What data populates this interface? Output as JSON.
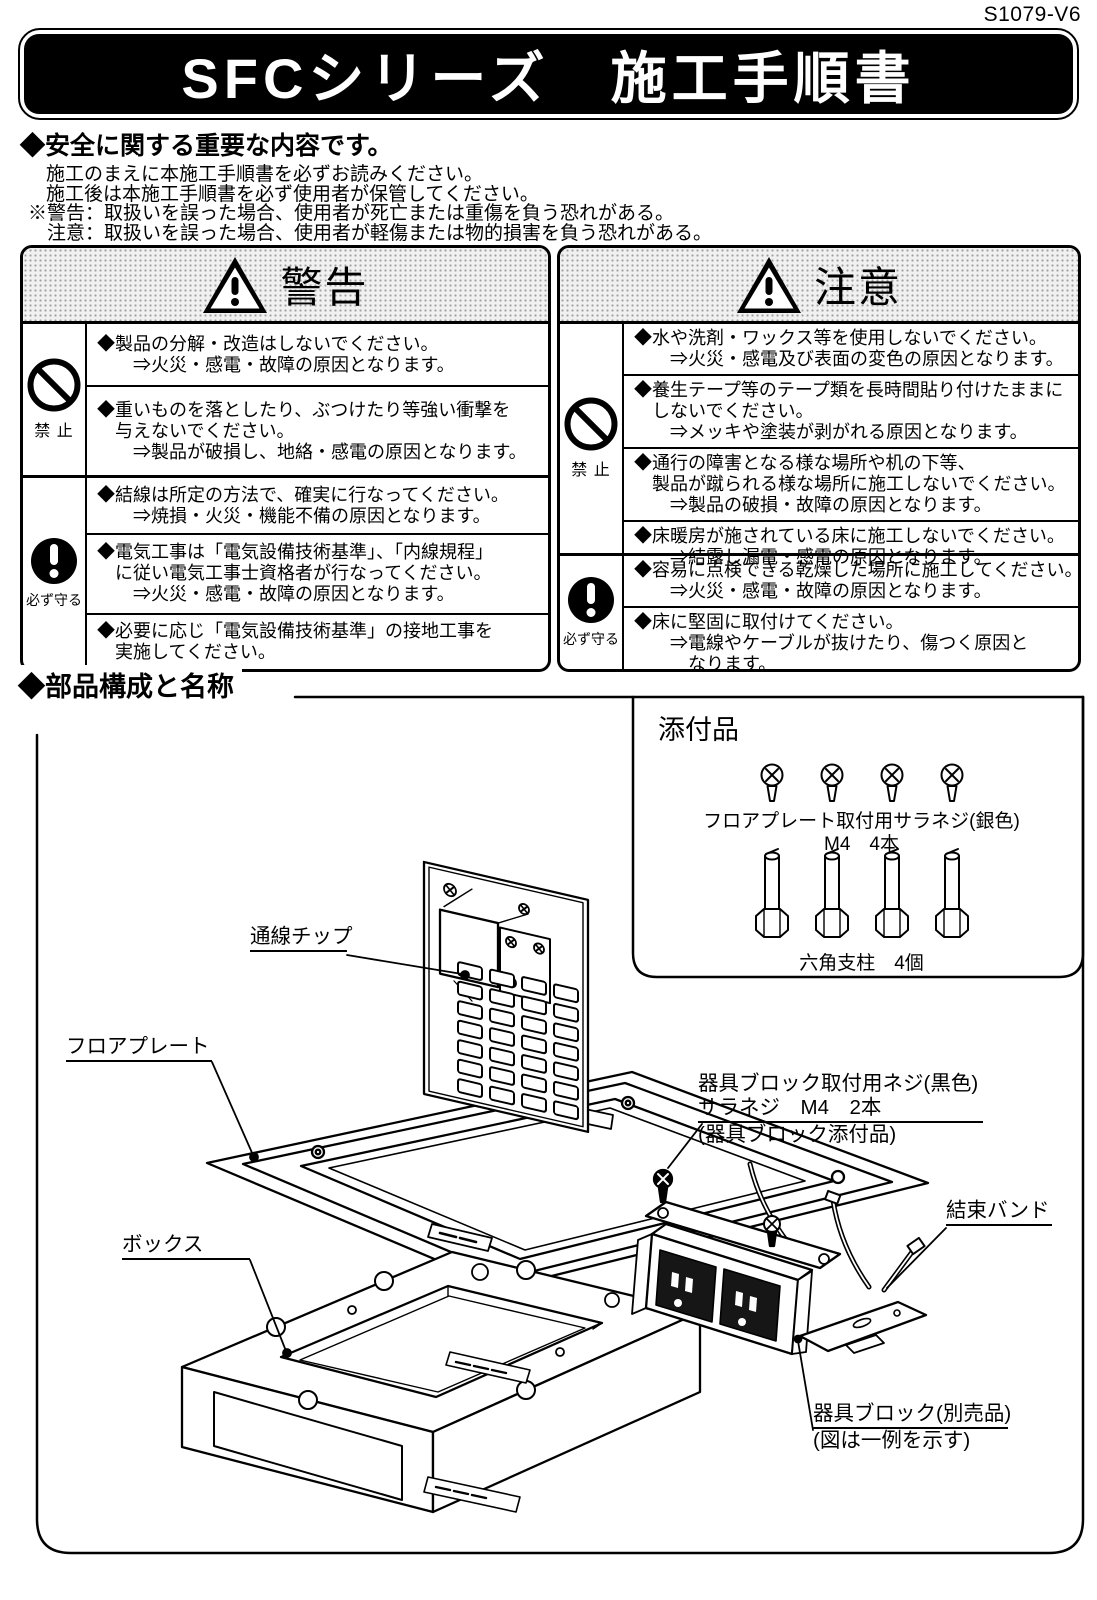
{
  "doc_code": "S1079-V6",
  "title": "SFCシリーズ　施工手順書",
  "safety": {
    "heading": "◆安全に関する重要な内容です。",
    "lines": [
      "施工のまえに本施工手順書を必ずお読みください。",
      "施工後は本施工手順書を必ず使用者が保管してください。",
      "※警告：取扱いを誤った場合、使用者が死亡または重傷を負う恐れがある。",
      "　注意：取扱いを誤った場合、使用者が軽傷または物的損害を負う恐れがある。"
    ]
  },
  "warning_table": {
    "header": "警告",
    "header_icon": "warning-triangle",
    "groups": [
      {
        "icon": "prohibition-circle",
        "icon_label": "禁 止",
        "rows": [
          [
            "◆製品の分解・改造はしないでください。",
            "　　⇒火災・感電・故障の原因となります。"
          ],
          [
            "◆重いものを落としたり、ぶつけたり等強い衝撃を",
            "　与えないでください。",
            "　　⇒製品が破損し、地絡・感電の原因となります。"
          ]
        ]
      },
      {
        "icon": "mandatory-circle",
        "icon_label": "必ず守る",
        "rows": [
          [
            "◆結線は所定の方法で、確実に行なってください。",
            "　　⇒焼損・火災・機能不備の原因となります。"
          ],
          [
            "◆電気工事は「電気設備技術基準」、「内線規程」",
            "　に従い電気工事士資格者が行なってください。",
            "　　⇒火災・感電・故障の原因となります。"
          ],
          [
            "◆必要に応じ「電気設備技術基準」の接地工事を",
            "　実施してください。"
          ]
        ]
      }
    ]
  },
  "caution_table": {
    "header": "注意",
    "header_icon": "warning-triangle",
    "groups": [
      {
        "icon": "prohibition-circle",
        "icon_label": "禁 止",
        "rows": [
          [
            "◆水や洗剤・ワックス等を使用しないでください。",
            "　　⇒火災・感電及び表面の変色の原因となります。"
          ],
          [
            "◆養生テープ等のテープ類を長時間貼り付けたままに",
            "　しないでください。",
            "　　⇒メッキや塗装が剥がれる原因となります。"
          ],
          [
            "◆通行の障害となる様な場所や机の下等、",
            "　製品が蹴られる様な場所に施工しないでください。",
            "　　⇒製品の破損・故障の原因となります。"
          ],
          [
            "◆床暖房が施されている床に施工しないでください。",
            "　　⇒結露し漏電・感電の原因となります。"
          ]
        ]
      },
      {
        "icon": "mandatory-circle",
        "icon_label": "必ず守る",
        "rows": [
          [
            "◆容易に点検できる乾燥した場所に施工してください。",
            "　　⇒火災・感電・故障の原因となります。"
          ],
          [
            "◆床に堅固に取付けてください。",
            "　　⇒電線やケーブルが抜けたり、傷つく原因と",
            "　　　なります。"
          ]
        ]
      }
    ]
  },
  "parts": {
    "heading": "◆部品構成と名称",
    "accessories": {
      "title": "添付品",
      "screw_caption_line1": "フロアプレート取付用サラネジ(銀色)",
      "screw_caption_line2": "M4　4本",
      "pillar_caption": "六角支柱　4個"
    },
    "labels": {
      "wiring_chip": "通線チップ",
      "floor_plate": "フロアプレート",
      "box": "ボックス",
      "block_screw_line1": "器具ブロック取付用ネジ(黒色)",
      "block_screw_line2": "サラネジ　M4　2本",
      "block_screw_line3": "(器具ブロック添付品)",
      "cable_tie": "結束バンド",
      "device_block_line1": "器具ブロック(別売品)",
      "device_block_line2": "(図は一例を示す)"
    }
  },
  "colors": {
    "ink": "#000000",
    "paper": "#ffffff",
    "halftone": "#f1f1f1"
  }
}
